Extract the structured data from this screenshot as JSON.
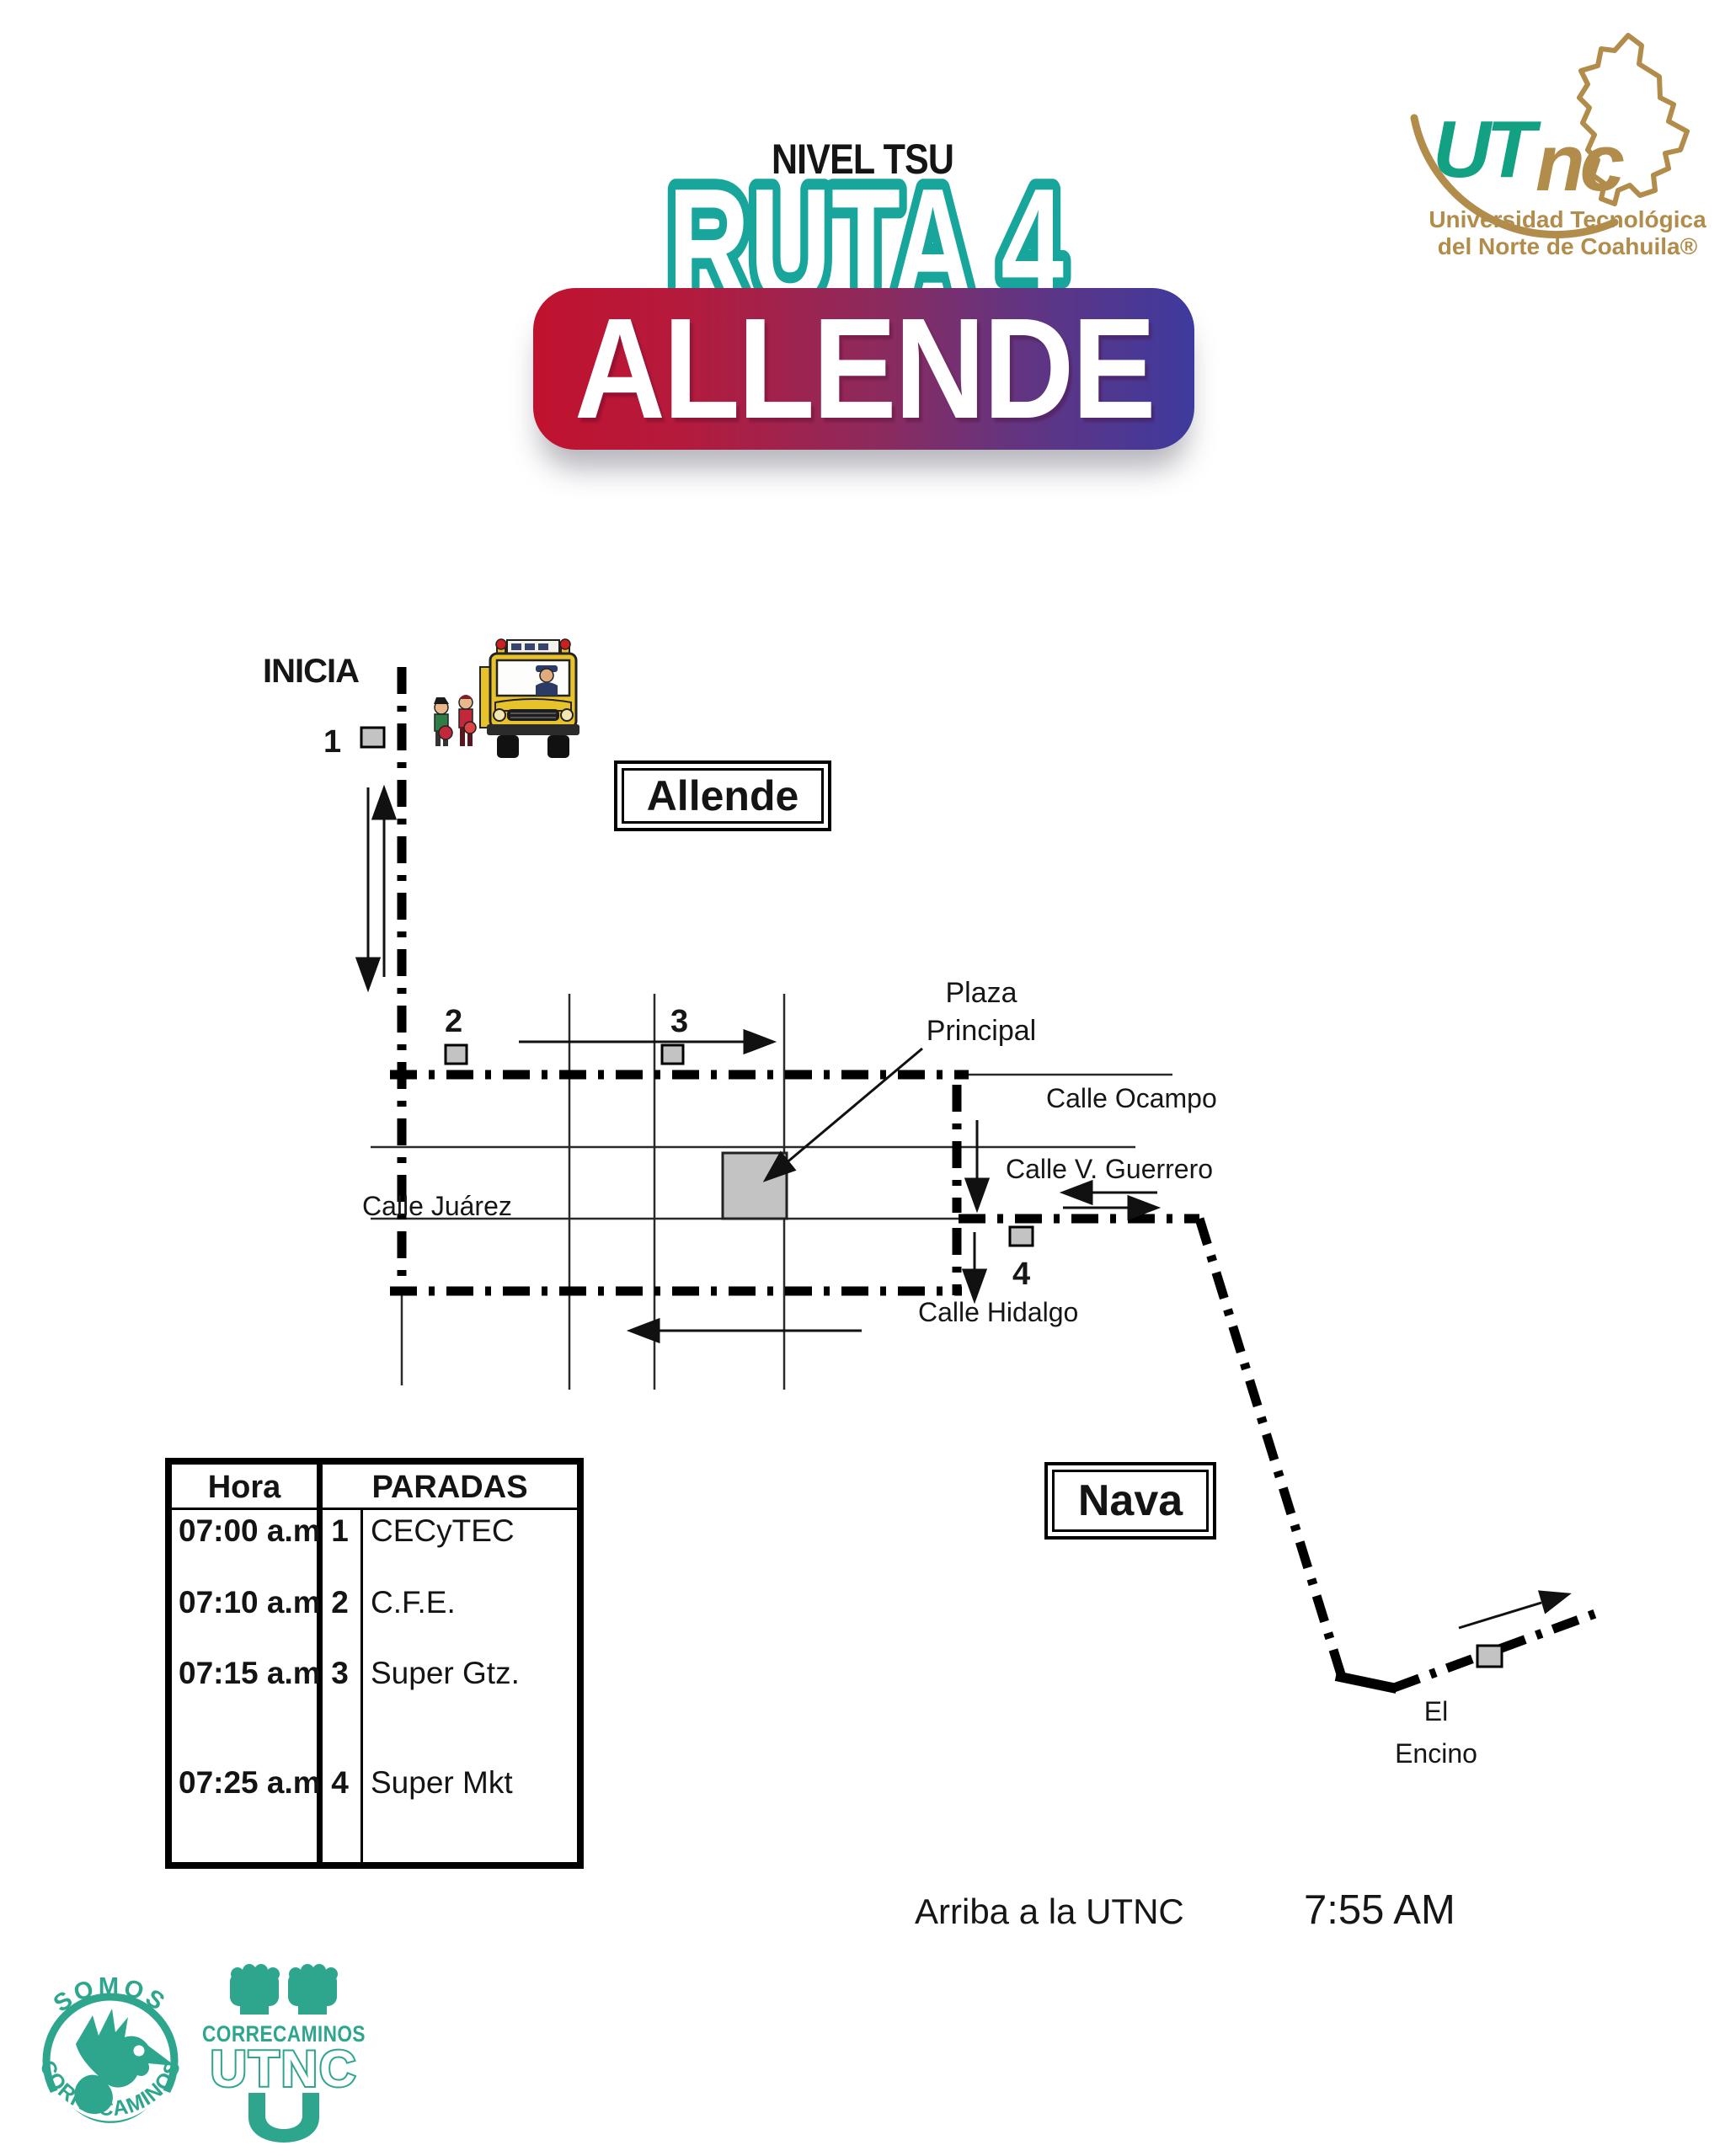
{
  "header": {
    "level": "NIVEL TSU",
    "route": "RUTA 4",
    "destination": "ALLENDE"
  },
  "university_logo": {
    "acronym_green": "UT",
    "acronym_gold": "nc",
    "name_line1": "Universidad Tecnológica",
    "name_line2": "del Norte de Coahuila®"
  },
  "map": {
    "start_label": "INICIA",
    "city_allende": "Allende",
    "city_nava": "Nava",
    "plaza_line1": "Plaza",
    "plaza_line2": "Principal",
    "streets": {
      "ocampo": "Calle Ocampo",
      "guerrero": "Calle V. Guerrero",
      "juarez": "Calle Juárez",
      "hidalgo": "Calle Hidalgo"
    },
    "encino_line1": "El",
    "encino_line2": "Encino",
    "stop1": "1",
    "stop2": "2",
    "stop3": "3",
    "stop4": "4"
  },
  "schedule": {
    "col_hora": "Hora",
    "col_paradas": "PARADAS",
    "rows": [
      {
        "time": "07:00 a.m",
        "num": "1",
        "stop": "CECyTEC"
      },
      {
        "time": "07:10 a.m",
        "num": "2",
        "stop": "C.F.E."
      },
      {
        "time": "07:15 a.m",
        "num": "3",
        "stop": "Super Gtz."
      },
      {
        "time": "07:25 a.m",
        "num": "4",
        "stop": "Super Mkt"
      }
    ]
  },
  "arrival": {
    "label": "Arriba a la UTNC",
    "time": "7:55 AM"
  },
  "footer_logos": {
    "somos_top": "SOMOS",
    "somos_bottom": "CORRECAMINOS",
    "stamp_word": "CORRECAMINOS",
    "stamp_acronym": "UTNC"
  },
  "colors": {
    "teal_outline": "#17a59c",
    "badge_red": "#c0122f",
    "badge_indigo": "#3e3a9e",
    "logo_gold": "#b18c4a",
    "logo_green": "#12a183",
    "correcaminos_green": "#2ea68e",
    "stop_marker_fill": "#c3c3c3",
    "route_black": "#000000"
  }
}
